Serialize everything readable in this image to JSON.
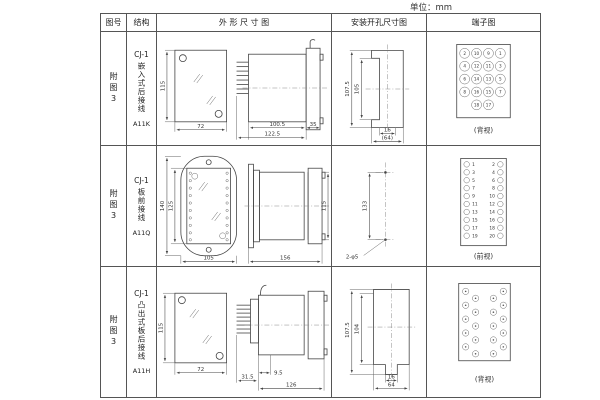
{
  "unit_label": "单位：mm",
  "header": {
    "figure": "图号",
    "structure": "结构",
    "outline": "外 形 尺 寸 图",
    "mounting": "安装开孔尺寸图",
    "terminal": "端子图"
  },
  "rows": [
    {
      "figure_no": "附图3",
      "structure": {
        "model": "CJ-1",
        "mount": "嵌入式后接线",
        "code": "A11K"
      },
      "outline_dims": {
        "height": "115",
        "width": "72",
        "body": "100.5",
        "overall": "122.5",
        "flange": "35"
      },
      "mounting_dims": {
        "outer_height": "107.5",
        "inner_height": "105",
        "slot_width": "16",
        "span": "(64)"
      },
      "terminal": {
        "view": "(背视)",
        "grid": [
          [
            "2",
            "10",
            "9",
            "1"
          ],
          [
            "4",
            "12",
            "11",
            "3"
          ],
          [
            "6",
            "14",
            "13",
            "5"
          ],
          [
            "8",
            "16",
            "15",
            "7"
          ]
        ],
        "bottom": [
          "18",
          "17"
        ]
      }
    },
    {
      "figure_no": "附图3",
      "structure": {
        "model": "CJ-1",
        "mount": "板前接线",
        "code": "A11Q"
      },
      "outline_dims": {
        "outer_height": "140",
        "inner_height": "125",
        "width": "105",
        "length": "156",
        "body_height": "115"
      },
      "mounting_dims": {
        "hole_span": "133",
        "holes": "2-φ5"
      },
      "terminal": {
        "view": "(前视)",
        "left_col": [
          "1",
          "3",
          "5",
          "7",
          "9",
          "11",
          "13",
          "15",
          "17",
          "19"
        ],
        "right_col": [
          "2",
          "4",
          "6",
          "8",
          "10",
          "12",
          "14",
          "16",
          "18",
          "20"
        ]
      }
    },
    {
      "figure_no": "附图3",
      "structure": {
        "model": "CJ-1",
        "mount": "凸出式板后接线",
        "code": "A11H"
      },
      "outline_dims": {
        "height": "115",
        "width": "72",
        "pin_depth": "31.5",
        "offset": "9.5",
        "length": "126"
      },
      "mounting_dims": {
        "outer_height": "107.5",
        "inner_height": "104",
        "slot_width": "16",
        "span": "64"
      },
      "terminal": {
        "view": "(背视)"
      }
    }
  ]
}
